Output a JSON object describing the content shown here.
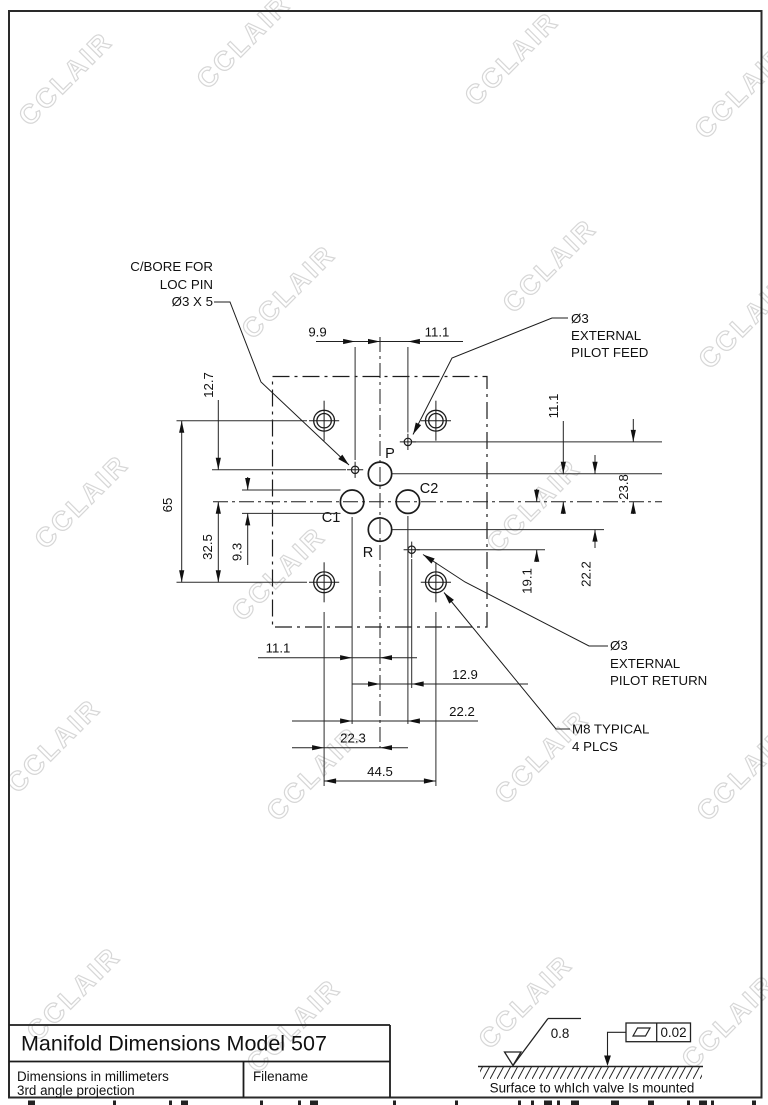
{
  "watermark": {
    "text": "CCLAIR"
  },
  "drawing": {
    "ports": {
      "p": "P",
      "c1": "C1",
      "c2": "C2",
      "r": "R"
    },
    "dimensions": {
      "top_9_9": "9.9",
      "top_11_1": "11.1",
      "left_12_7": "12.7",
      "left_65": "65",
      "left_32_5": "32.5",
      "left_9_3": "9.3",
      "right_11_1": "11.1",
      "right_23_8": "23.8",
      "right_22_2": "22.2",
      "right_19_1": "19.1",
      "bottom_11_1": "11.1",
      "bottom_12_9": "12.9",
      "bottom_22_2": "22.2",
      "bottom_22_3": "22.3",
      "bottom_44_5": "44.5"
    },
    "notes": {
      "cbore_line1": "C/BORE FOR",
      "cbore_line2": "LOC PIN",
      "cbore_line3": "Ø3 X 5",
      "feed_line1": "Ø3",
      "feed_line2": "EXTERNAL",
      "feed_line3": "PILOT FEED",
      "return_line1": "Ø3",
      "return_line2": "EXTERNAL",
      "return_line3": "PILOT RETURN",
      "m8_line1": "M8 TYPICAL",
      "m8_line2": "4 PLCS"
    }
  },
  "title_block": {
    "title": "Manifold Dimensions Model 507",
    "note_line1": "Dimensions in millimeters",
    "note_line2": "3rd angle projection",
    "filename_label": "Filename"
  },
  "mounting": {
    "roughness": "0.8",
    "flatness": "0.02",
    "caption": "Surface to whIch valve Is mounted"
  }
}
